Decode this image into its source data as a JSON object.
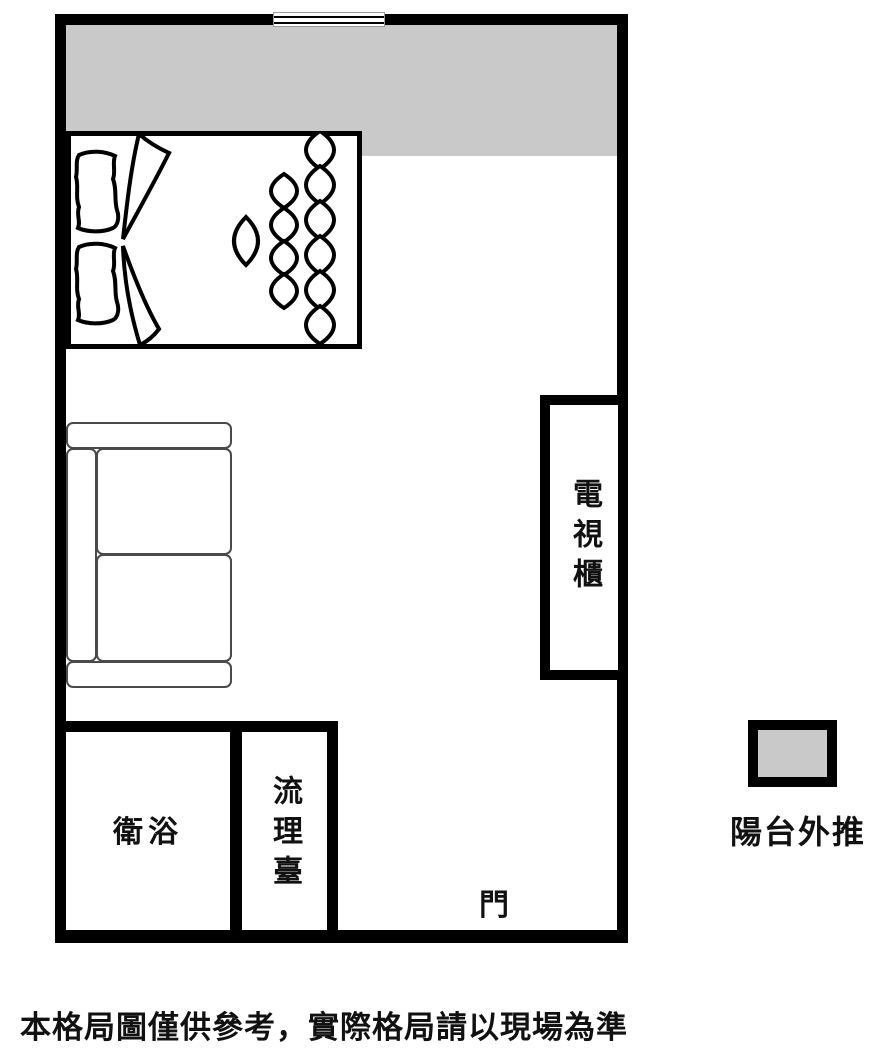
{
  "figure": {
    "type": "apartment-floor-plan"
  },
  "labels": {
    "tv_cabinet": "電視櫃",
    "bathroom": "衛浴",
    "kitchen_counter": "流理臺",
    "door": "門"
  },
  "legend": {
    "label": "陽台外推",
    "swatch_color": "#c9c9c9"
  },
  "disclaimer": "本格局圖僅供參考，實際格局請以現場為準",
  "colors": {
    "wall": "#000000",
    "balcony_fill": "#c9c9c9",
    "background": "#ffffff"
  }
}
